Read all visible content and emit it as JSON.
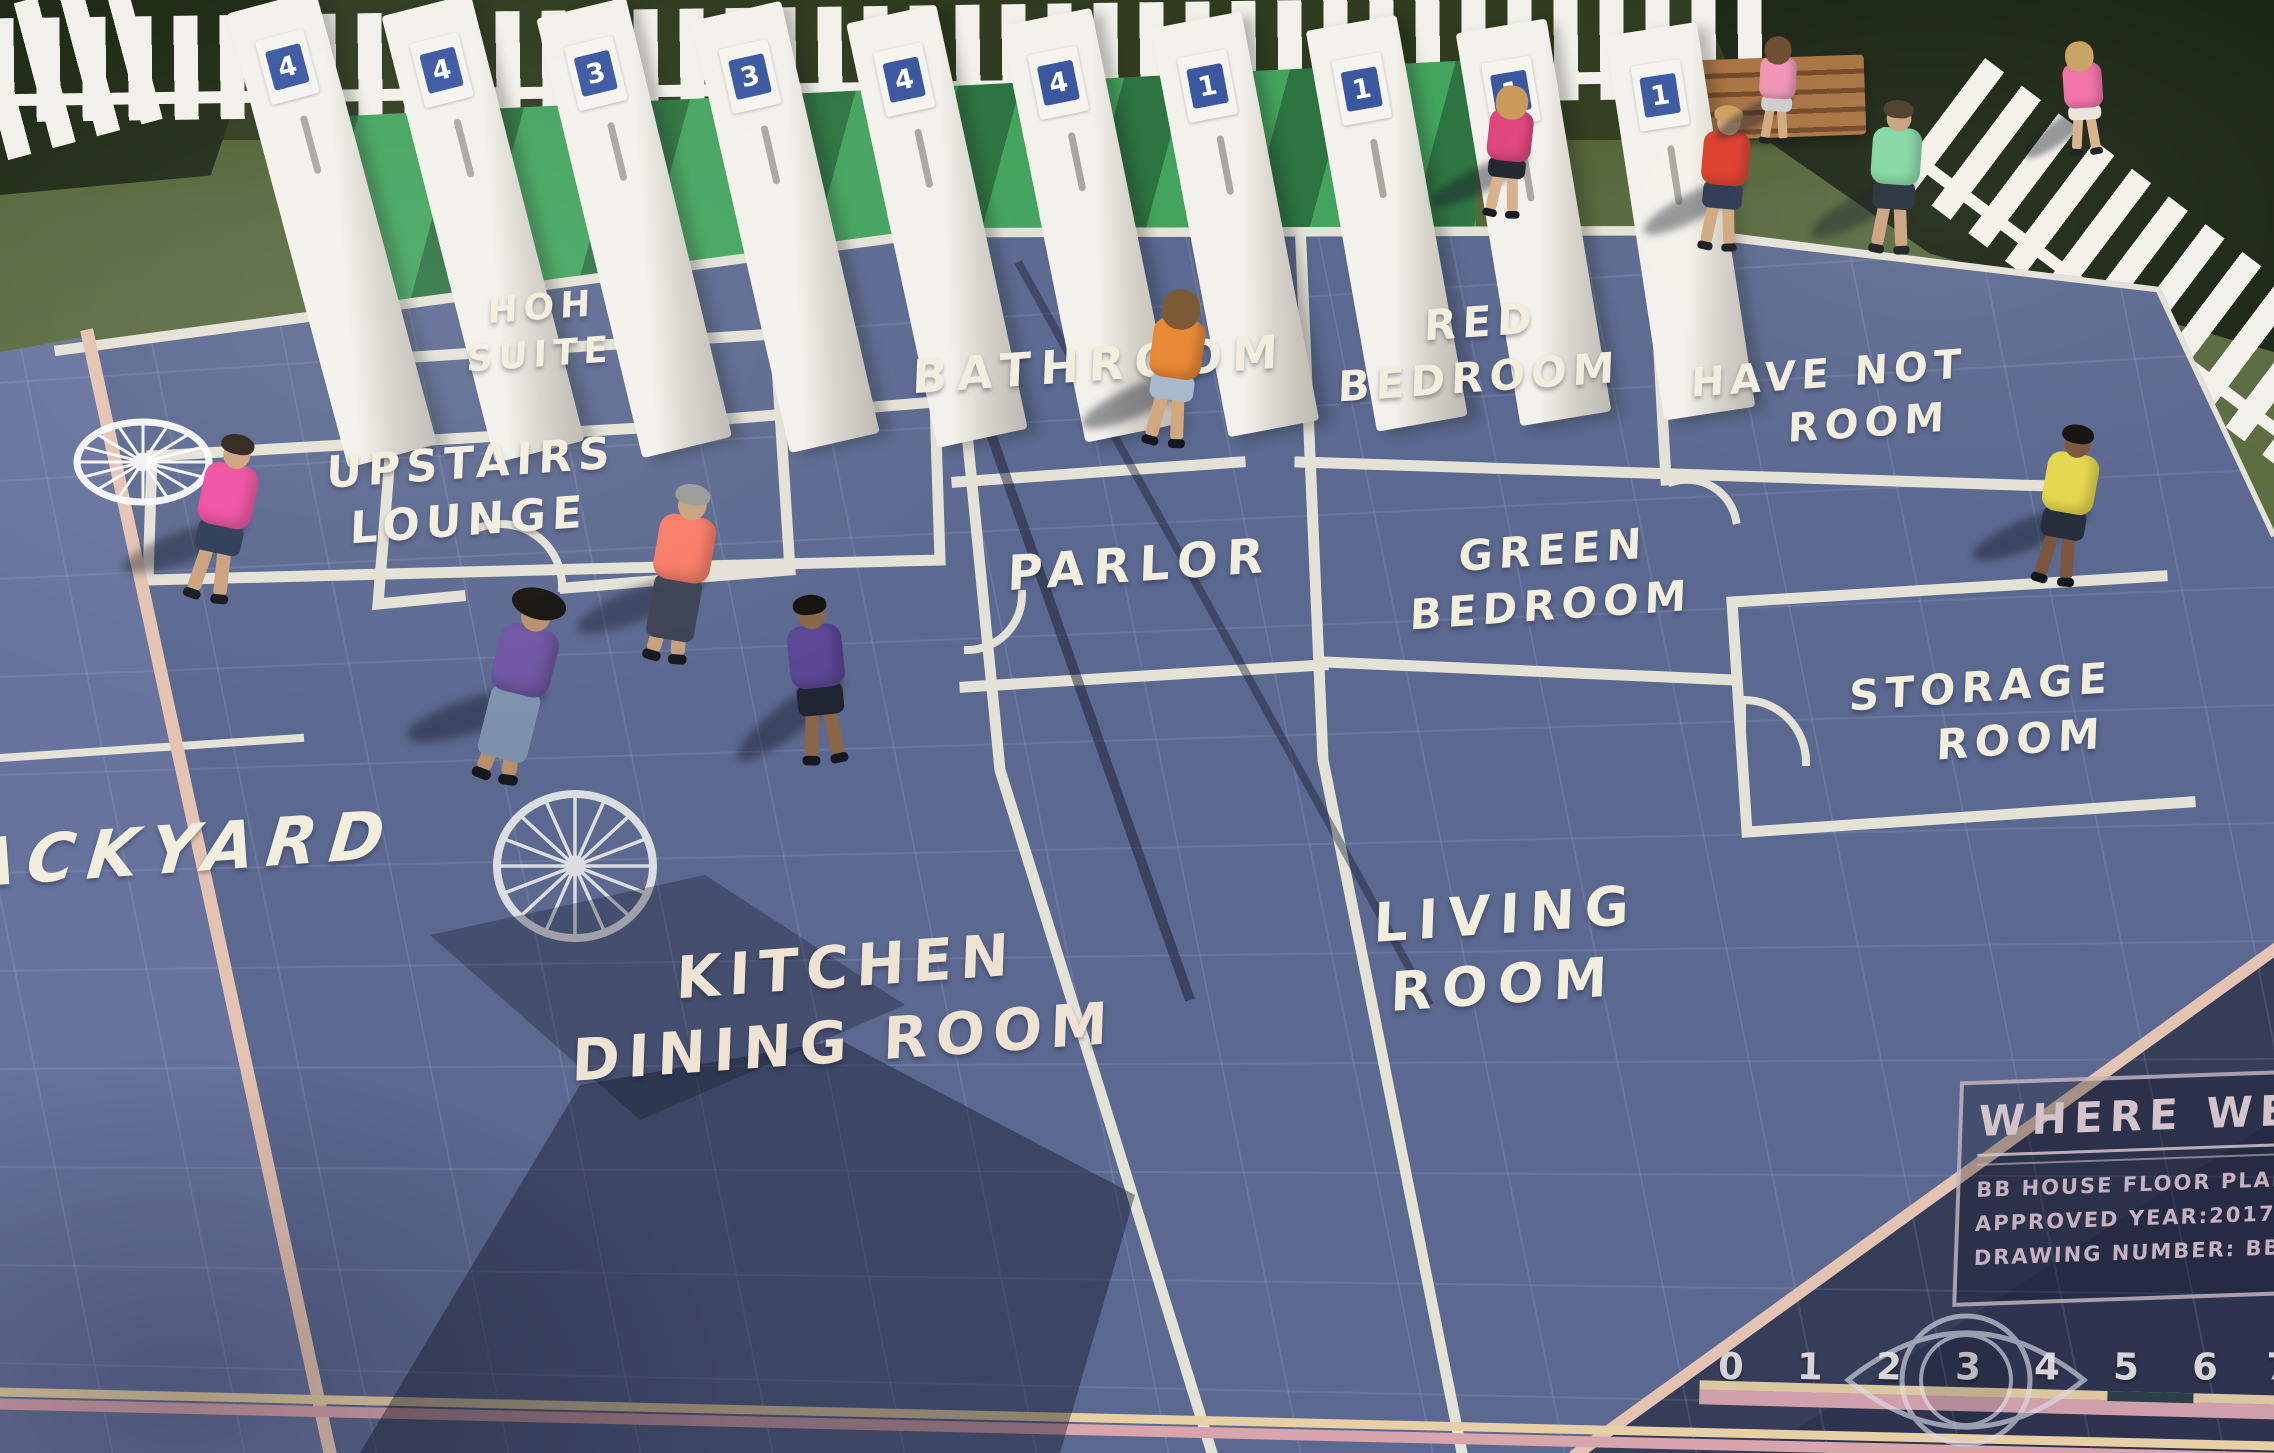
{
  "palette": {
    "grass": "#5c6d42",
    "mat_blue": "#5b6890",
    "backyard_blue": "#6a76a0",
    "backdrop_green": "#43a45e",
    "wall_line": "#ece8db",
    "frame_line": "#e5c3b2",
    "dark_band": "#363d59",
    "fence": "#f2f0ea",
    "card_blue": "#3a57a0",
    "title_text": "#d5c3cc",
    "ruler_bar_cream": "#dcc8a0",
    "ruler_bar_pink": "#cfa0ac"
  },
  "floor_plan": {
    "rooms": {
      "hoh": {
        "line1": "HOH",
        "line2": "SUITE"
      },
      "upstairs_lounge": {
        "line1": "UPSTAIRS",
        "line2": "LOUNGE"
      },
      "bathroom": {
        "line1": "BATHROOM"
      },
      "parlor": {
        "line1": "PARLOR"
      },
      "red_bedroom": {
        "line1": "RED",
        "line2": "BEDROOM"
      },
      "green_bedroom": {
        "line1": "GREEN",
        "line2": "BEDROOM"
      },
      "have_not": {
        "line1": "HAVE NOT",
        "line2": "ROOM"
      },
      "storage": {
        "line1": "STORAGE",
        "line2": "ROOM"
      },
      "living": {
        "line1": "LIVING",
        "line2": "ROOM"
      },
      "kitchen": {
        "line1": "KITCHEN",
        "line2": "DINING ROOM"
      },
      "backyard": {
        "line1": "BACKYARD"
      }
    },
    "title_block": {
      "heading": "WHERE WERE",
      "line1": "BB HOUSE FLOOR PLAN BLU",
      "line2": "APPROVED YEAR:2017",
      "line3": "DRAWING NUMBER: BB1"
    },
    "ruler": {
      "numbers": [
        "0",
        "1",
        "2",
        "3",
        "4",
        "5",
        "6",
        "7"
      ]
    }
  },
  "doors": {
    "numbers": [
      "4",
      "4",
      "3",
      "3",
      "4",
      "4",
      "1",
      "1",
      "1",
      "1"
    ]
  },
  "watermark": {
    "icon": "cbs-eye"
  },
  "people": [
    {
      "id": "man-pink-shirt",
      "shirt": "#ee4fa0",
      "shorts": "#2c3a55",
      "hair": "#2a2118",
      "skin": "#caa17e"
    },
    {
      "id": "man-coral-shirt",
      "shirt": "#f87c66",
      "shorts": "#3a4252",
      "hair": "#9a9a98",
      "skin": "#c9a07d"
    },
    {
      "id": "man-cowboy-purple",
      "shirt": "#6f55a2",
      "shorts": "#7e92ad",
      "hair": "#1a1712",
      "skin": "#b98f6a"
    },
    {
      "id": "man-purple-shirt",
      "shirt": "#5b4795",
      "shorts": "#1e2430",
      "hair": "#15120e",
      "skin": "#8a6547"
    },
    {
      "id": "woman-orange-shirt",
      "shirt": "#e98936",
      "shorts": "#a9b9cb",
      "hair": "#7b5a35",
      "skin": "#d2a87f"
    },
    {
      "id": "woman-pink-top",
      "shirt": "#e0457c",
      "shorts": "#20262e",
      "hair": "#c79a5b",
      "skin": "#d8b08a"
    },
    {
      "id": "man-red-shirt",
      "shirt": "#dd3b2a",
      "shorts": "#27354e",
      "hair": "#caa05c",
      "skin": "#d0a67e"
    },
    {
      "id": "man-mint-shirt",
      "shirt": "#82d8a2",
      "shorts": "#222b38",
      "hair": "#4a3a28",
      "skin": "#c9a07d"
    },
    {
      "id": "woman-near-bench",
      "shirt": "#ef93b5",
      "shorts": "#cccccc",
      "hair": "#6b4a2d",
      "skin": "#d2a87f"
    },
    {
      "id": "woman-by-fence",
      "shirt": "#f06fa6",
      "shorts": "#e8e4da",
      "hair": "#c9a061",
      "skin": "#d8b08a"
    },
    {
      "id": "man-yellow-shirt",
      "shirt": "#e6d84e",
      "shorts": "#262e3c",
      "hair": "#141210",
      "skin": "#7a573c"
    }
  ]
}
